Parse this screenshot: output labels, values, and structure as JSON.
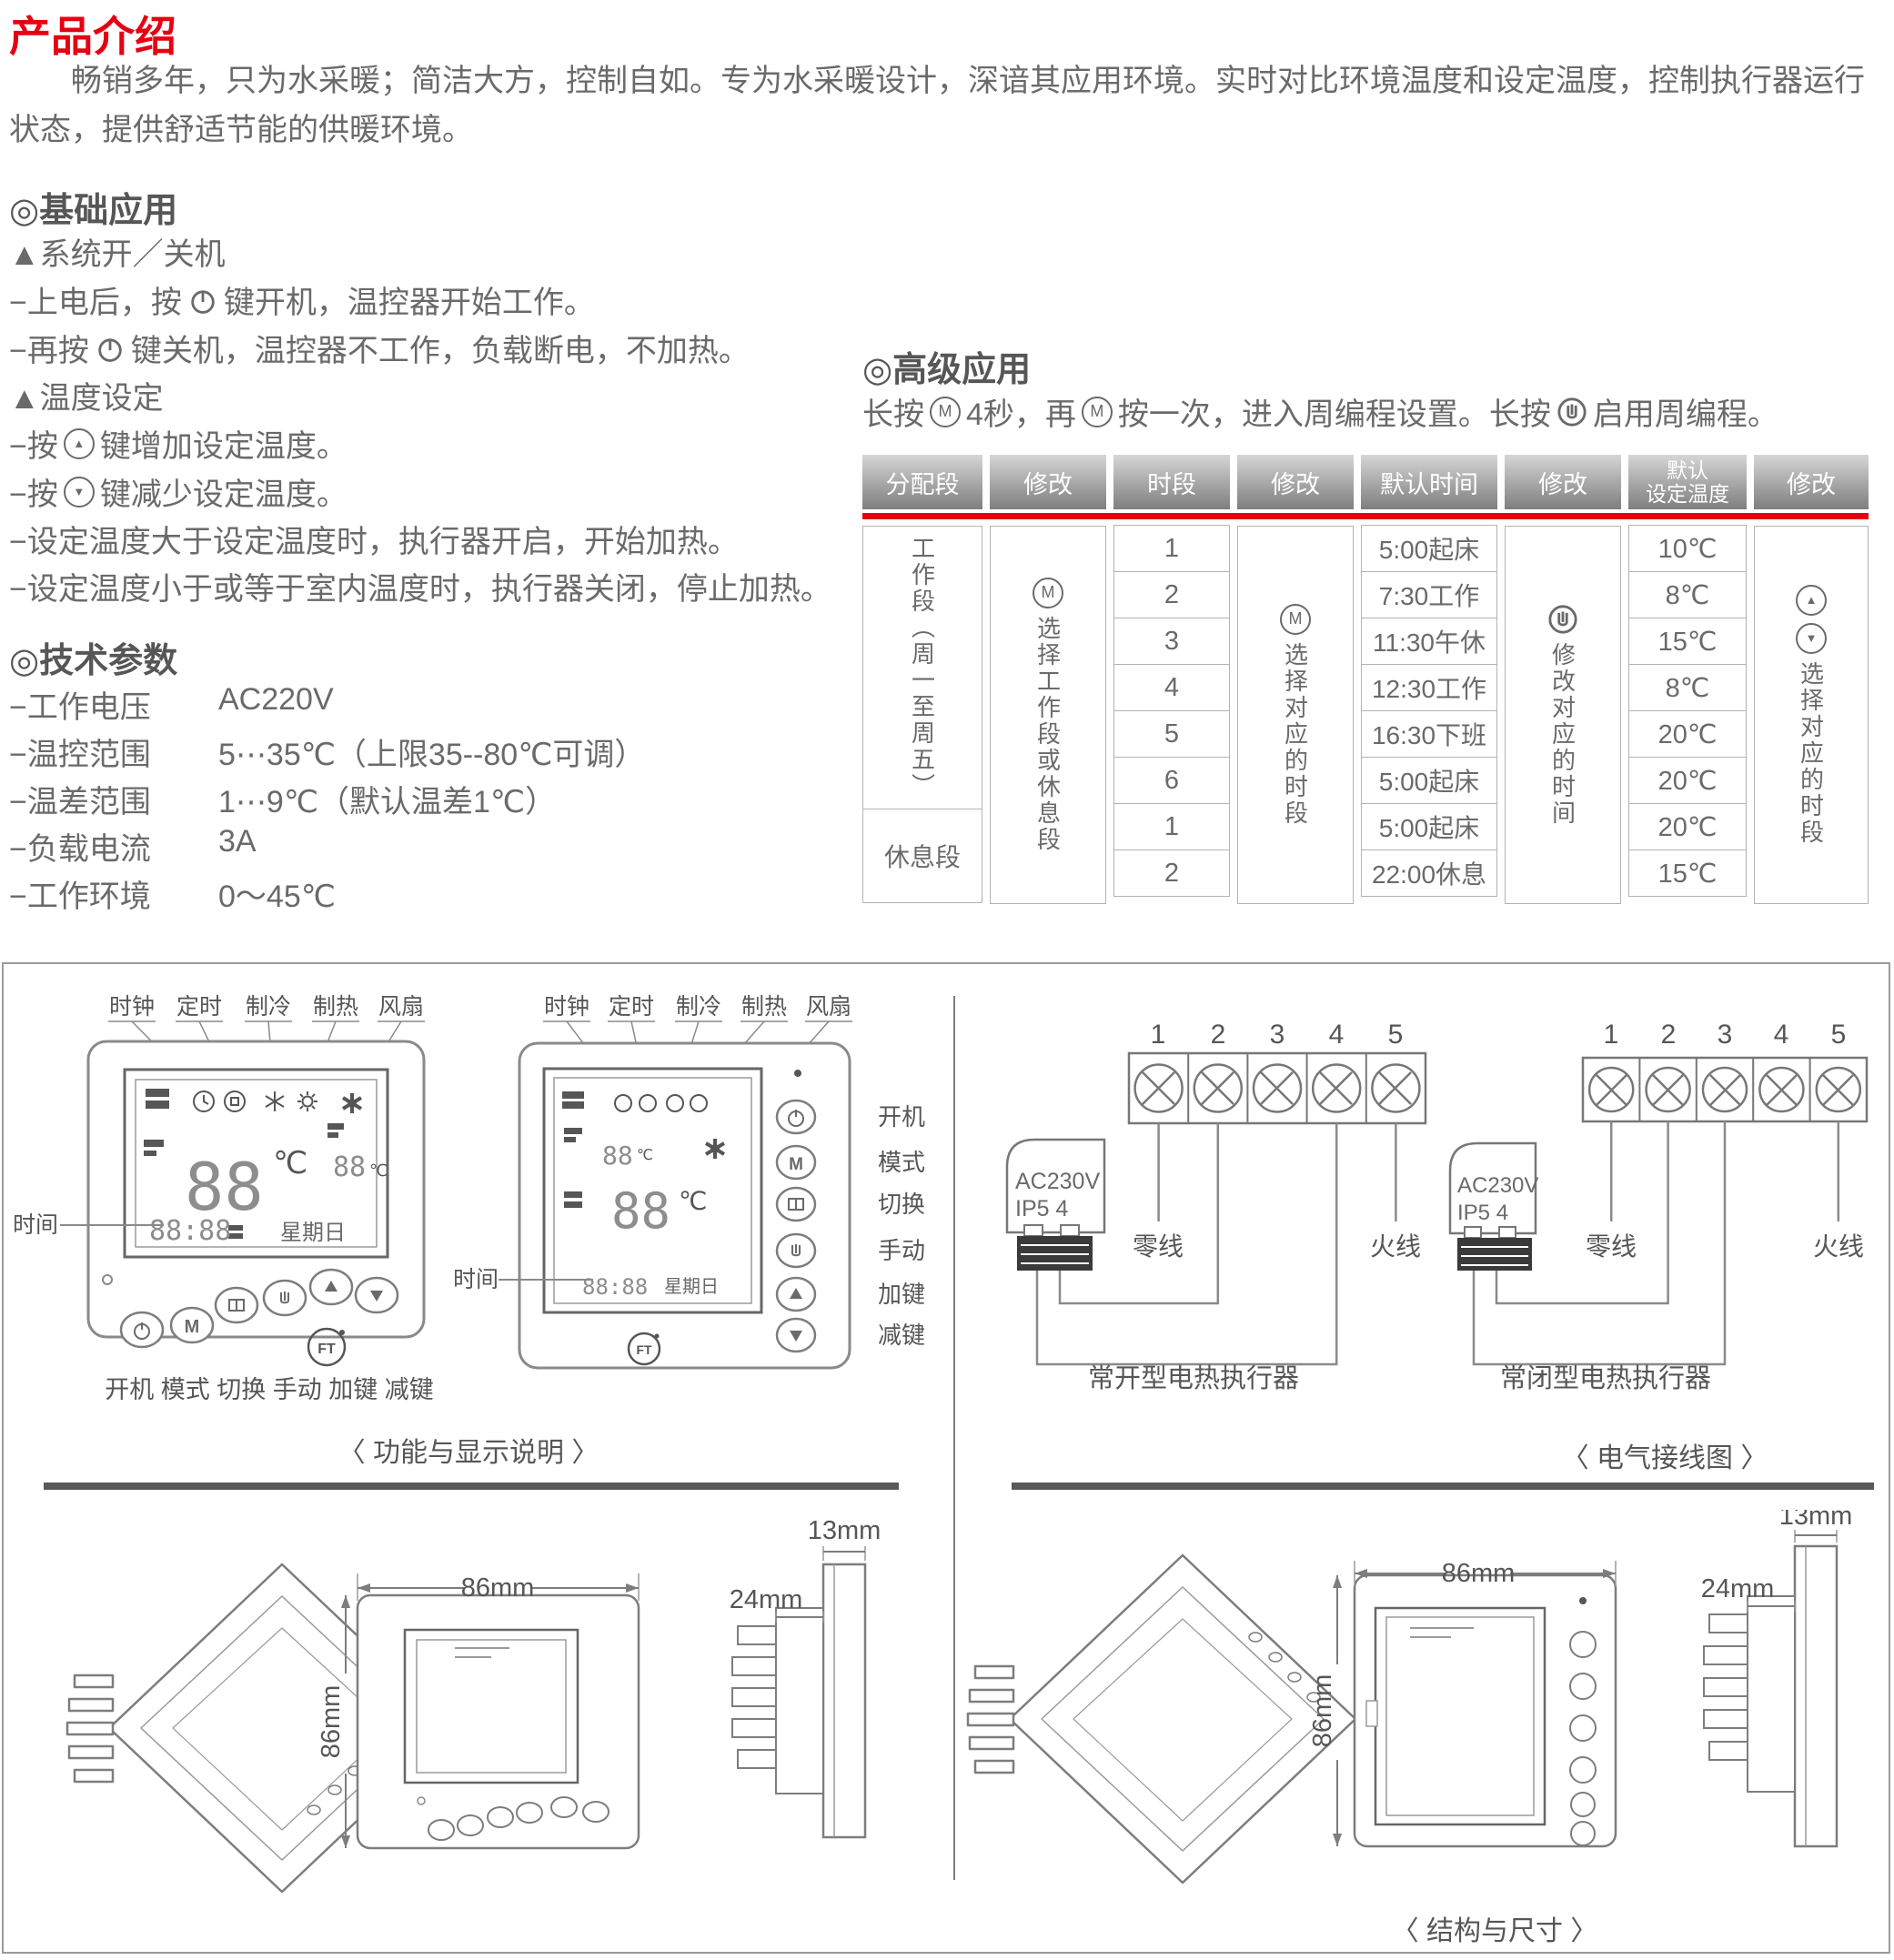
{
  "title": "产品介绍",
  "intro": "畅销多年，只为水采暖；简洁大方，控制自如。专为水采暖设计，深谙其应用环境。实时对比环境温度和设定温度，控制执行器运行状态，提供舒适节能的供暖环境。",
  "basic": {
    "heading": "◎基础应用",
    "sub_power": "▲系统开／关机",
    "l1a": "−上电后，按",
    "l1b": "键开机，温控器开始工作。",
    "l2a": "−再按",
    "l2b": "键关机，温控器不工作，负载断电，不加热。",
    "sub_temp": "▲温度设定",
    "l3a": "−按",
    "l3b": "键增加设定温度。",
    "l4a": "−按",
    "l4b": "键减少设定温度。",
    "l5": "−设定温度大于设定温度时，执行器开启，开始加热。",
    "l6": "−设定温度小于或等于室内温度时，执行器关闭，停止加热。"
  },
  "tech": {
    "heading": "◎技术参数",
    "rows": [
      {
        "label": "−工作电压",
        "value": "AC220V"
      },
      {
        "label": "−温控范围",
        "value": "5⋯35℃（上限35--80℃可调）"
      },
      {
        "label": "−温差范围",
        "value": "1⋯9℃（默认温差1℃）"
      },
      {
        "label": "−负载电流",
        "value": "3A"
      },
      {
        "label": "−工作环境",
        "value": "0～45℃"
      }
    ]
  },
  "advanced": {
    "heading": "◎高级应用",
    "i1": "长按",
    "i2": "4秒，再",
    "i3": "按一次，进入周编程设置。长按",
    "i4": "启用周编程。"
  },
  "table": {
    "h1": "分配段",
    "h2": "修改",
    "h3": "时段",
    "h4": "修改",
    "h5": "默认时间",
    "h6": "修改",
    "h7a": "默认",
    "h7b": "设定温度",
    "h8": "修改",
    "work_label": "工作段（周一至周五）",
    "rest_label": "休息段",
    "col2_text": "选择工作段或休息段",
    "col3": [
      "1",
      "2",
      "3",
      "4",
      "5",
      "6",
      "1",
      "2"
    ],
    "col4_text": "选择对应的时段",
    "col5": [
      "5:00起床",
      "7:30工作",
      "11:30午休",
      "12:30工作",
      "16:30下班",
      "5:00起床",
      "5:00起床",
      "22:00休息"
    ],
    "col6_text": "修改对应的时间",
    "col7": [
      "10℃",
      "8℃",
      "15℃",
      "8℃",
      "20℃",
      "20℃",
      "20℃",
      "15℃"
    ],
    "col8_text": "选择对应的时段"
  },
  "func": {
    "display_labels": [
      "时钟",
      "定时",
      "制冷",
      "制热",
      "风扇"
    ],
    "time_label": "时间",
    "bottom_labels": "开机 模式 切换 手动 加键 减键",
    "side_labels": [
      "开机",
      "模式",
      "切换",
      "手动",
      "加键",
      "减键"
    ],
    "lcd": {
      "temp": "88",
      "unit": "℃",
      "set": "88",
      "time": "88:88",
      "week": "星期日",
      "m": "M",
      "ft": "FT"
    },
    "caption": "〈 功能与显示说明 〉"
  },
  "wiring": {
    "terminals": [
      "1",
      "2",
      "3",
      "4",
      "5"
    ],
    "actuator1": "AC230V",
    "actuator2": "IP5 4",
    "neutral": "零线",
    "live": "火线",
    "caption_no": "常开型电热执行器",
    "caption_nc": "常闭型电热执行器",
    "caption": "〈 电气接线图 〉"
  },
  "dims": {
    "w": "86mm",
    "h": "86mm",
    "d": "24mm",
    "p": "13mm",
    "caption": "〈 结构与尺寸 〉"
  },
  "colors": {
    "accent_red": "#e60012",
    "text": "#6a6a6a",
    "heading": "#565656",
    "line_gray": "#8a8a8a"
  }
}
